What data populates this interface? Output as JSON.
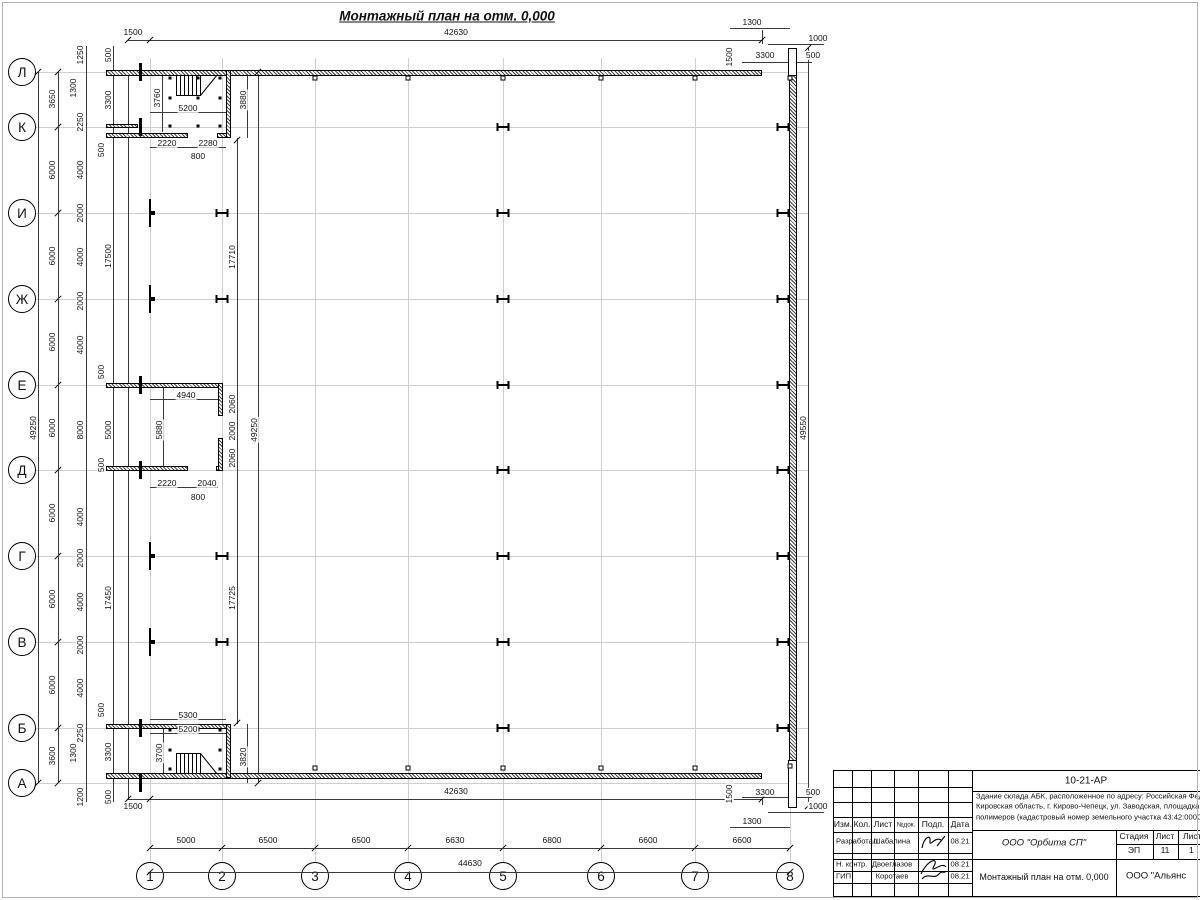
{
  "sheet": {
    "title": "Монтажный план на отм. 0,000"
  },
  "axes": {
    "rows": [
      [
        "Л",
        72
      ],
      [
        "К",
        127
      ],
      [
        "И",
        213
      ],
      [
        "Ж",
        299
      ],
      [
        "Е",
        385
      ],
      [
        "Д",
        470
      ],
      [
        "Г",
        556
      ],
      [
        "В",
        642
      ],
      [
        "Б",
        728
      ],
      [
        "А",
        783
      ]
    ],
    "cols": [
      [
        "1",
        150
      ],
      [
        "2",
        222
      ],
      [
        "3",
        315
      ],
      [
        "4",
        408
      ],
      [
        "5",
        503
      ],
      [
        "6",
        601
      ],
      [
        "7",
        695
      ],
      [
        "8",
        790
      ]
    ]
  },
  "geometry": {
    "dim_labels": [
      [
        "1500",
        133,
        32,
        0
      ],
      [
        "42630",
        456,
        32,
        0
      ],
      [
        "1300",
        752,
        22,
        0
      ],
      [
        "1000",
        818,
        38,
        0
      ],
      [
        "3300",
        765,
        55,
        0
      ],
      [
        "500",
        813,
        55,
        0
      ],
      [
        "1500",
        729,
        57,
        1
      ],
      [
        "1500",
        729,
        794,
        1
      ],
      [
        "3300",
        765,
        792,
        0
      ],
      [
        "500",
        813,
        792,
        0
      ],
      [
        "1000",
        818,
        806,
        0
      ],
      [
        "1300",
        752,
        821,
        0
      ],
      [
        "42630",
        456,
        791,
        0
      ],
      [
        "1500",
        133,
        806,
        0
      ],
      [
        "5000",
        186,
        840,
        0
      ],
      [
        "6500",
        268,
        840,
        0
      ],
      [
        "6500",
        361,
        840,
        0
      ],
      [
        "6630",
        455,
        840,
        0
      ],
      [
        "6800",
        552,
        840,
        0
      ],
      [
        "6600",
        648,
        840,
        0
      ],
      [
        "6600",
        742,
        840,
        0
      ],
      [
        "44630",
        470,
        863,
        0
      ],
      [
        "49250",
        33,
        428,
        1
      ],
      [
        "3650",
        52,
        99,
        1
      ],
      [
        "6000",
        52,
        170,
        1
      ],
      [
        "6000",
        52,
        256,
        1
      ],
      [
        "6000",
        52,
        342,
        1
      ],
      [
        "6000",
        52,
        428,
        1
      ],
      [
        "6000",
        52,
        513,
        1
      ],
      [
        "6000",
        52,
        599,
        1
      ],
      [
        "6000",
        52,
        685,
        1
      ],
      [
        "3600",
        52,
        756,
        1
      ],
      [
        "1250",
        80,
        55,
        1
      ],
      [
        "1300",
        73,
        88,
        1
      ],
      [
        "2250",
        80,
        122,
        1
      ],
      [
        "4000",
        80,
        170,
        1
      ],
      [
        "2000",
        80,
        213,
        1
      ],
      [
        "4000",
        80,
        257,
        1
      ],
      [
        "2000",
        80,
        301,
        1
      ],
      [
        "4000",
        80,
        345,
        1
      ],
      [
        "8000",
        80,
        430,
        1
      ],
      [
        "4000",
        80,
        517,
        1
      ],
      [
        "2000",
        80,
        558,
        1
      ],
      [
        "4000",
        80,
        602,
        1
      ],
      [
        "2000",
        80,
        645,
        1
      ],
      [
        "4000",
        80,
        688,
        1
      ],
      [
        "2250",
        80,
        733,
        1
      ],
      [
        "1300",
        73,
        753,
        1
      ],
      [
        "1200",
        80,
        797,
        1
      ],
      [
        "500",
        108,
        55,
        1
      ],
      [
        "3300",
        108,
        100,
        1
      ],
      [
        "500",
        101,
        150,
        1
      ],
      [
        "17500",
        108,
        256,
        1
      ],
      [
        "500",
        101,
        372,
        1
      ],
      [
        "5000",
        108,
        430,
        1
      ],
      [
        "500",
        101,
        465,
        1
      ],
      [
        "17450",
        108,
        598,
        1
      ],
      [
        "500",
        101,
        710,
        1
      ],
      [
        "3300",
        108,
        752,
        1
      ],
      [
        "500",
        108,
        797,
        1
      ],
      [
        "17710",
        232,
        257,
        1
      ],
      [
        "2060",
        232,
        404,
        1
      ],
      [
        "2000",
        232,
        431,
        1
      ],
      [
        "2060",
        232,
        458,
        1
      ],
      [
        "17725",
        232,
        598,
        1
      ],
      [
        "49250",
        254,
        430,
        1
      ],
      [
        "3880",
        243,
        100,
        1
      ],
      [
        "3820",
        243,
        757,
        1
      ],
      [
        "49550",
        803,
        428,
        1
      ],
      [
        "3760",
        157,
        98,
        1
      ],
      [
        "5200",
        188,
        108,
        0
      ],
      [
        "2220",
        167,
        143,
        0
      ],
      [
        "2280",
        208,
        143,
        0
      ],
      [
        "800",
        198,
        156,
        0
      ],
      [
        "4940",
        186,
        395,
        0
      ],
      [
        "5880",
        159,
        430,
        1
      ],
      [
        "2220",
        167,
        483,
        0
      ],
      [
        "2040",
        207,
        483,
        0
      ],
      [
        "800",
        198,
        497,
        0
      ],
      [
        "5300",
        188,
        715,
        0
      ],
      [
        "5200",
        188,
        729,
        0
      ],
      [
        "3700",
        159,
        753,
        1
      ]
    ],
    "lines": [
      [
        128,
        40,
        634,
        1
      ],
      [
        742,
        62,
        70,
        1
      ],
      [
        768,
        44,
        56,
        1
      ],
      [
        730,
        28,
        60,
        1
      ],
      [
        128,
        799,
        634,
        1
      ],
      [
        742,
        797,
        70,
        1
      ],
      [
        768,
        812,
        56,
        1
      ],
      [
        730,
        827,
        60,
        1
      ],
      [
        150,
        848,
        640,
        1
      ],
      [
        150,
        872,
        640,
        1
      ],
      [
        38,
        72,
        1,
        711
      ],
      [
        58,
        72,
        1,
        711
      ],
      [
        86,
        46,
        1,
        756
      ],
      [
        113,
        46,
        1,
        756
      ],
      [
        237,
        138,
        1,
        586
      ],
      [
        258,
        72,
        1,
        711
      ],
      [
        808,
        48,
        1,
        758
      ],
      [
        247,
        72,
        1,
        66
      ],
      [
        247,
        724,
        1,
        59
      ],
      [
        150,
        112,
        76,
        1
      ],
      [
        150,
        147,
        76,
        1
      ],
      [
        150,
        399,
        68,
        1
      ],
      [
        150,
        487,
        68,
        1
      ],
      [
        150,
        719,
        76,
        1
      ],
      [
        150,
        733,
        76,
        1
      ],
      [
        162,
        76,
        1,
        56
      ],
      [
        163,
        387,
        1,
        79
      ],
      [
        163,
        727,
        1,
        46
      ],
      [
        128,
        70,
        1,
        729
      ],
      [
        762,
        30,
        1,
        14
      ],
      [
        762,
        793,
        1,
        12
      ]
    ],
    "walls": [
      [
        106,
        70,
        656,
        6
      ],
      [
        106,
        773,
        656,
        6
      ],
      [
        789,
        74,
        8,
        688
      ],
      [
        106,
        133,
        82,
        5
      ],
      [
        217,
        133,
        14,
        5
      ],
      [
        226,
        70,
        5,
        68
      ],
      [
        106,
        383,
        114,
        5
      ],
      [
        106,
        466,
        82,
        5
      ],
      [
        216,
        466,
        7,
        5
      ],
      [
        218,
        383,
        5,
        33
      ],
      [
        218,
        438,
        5,
        33
      ],
      [
        106,
        724,
        125,
        5
      ],
      [
        226,
        724,
        5,
        54
      ],
      [
        106,
        124,
        32,
        4
      ]
    ],
    "whiteboxes": [
      [
        788,
        48,
        9,
        28
      ],
      [
        788,
        760,
        9,
        48
      ]
    ],
    "caps": [
      [
        139,
        63
      ],
      [
        139,
        118
      ],
      [
        139,
        376
      ],
      [
        139,
        461
      ],
      [
        139,
        719
      ],
      [
        139,
        774
      ]
    ],
    "hcols": [
      [
        503,
        127
      ],
      [
        503,
        213
      ],
      [
        503,
        299
      ],
      [
        503,
        385
      ],
      [
        503,
        470
      ],
      [
        503,
        556
      ],
      [
        503,
        642
      ],
      [
        503,
        728
      ],
      [
        222,
        213
      ],
      [
        222,
        299
      ],
      [
        222,
        556
      ],
      [
        222,
        642
      ],
      [
        783,
        127
      ],
      [
        783,
        213
      ],
      [
        783,
        299
      ],
      [
        783,
        385
      ],
      [
        783,
        470
      ],
      [
        783,
        556
      ],
      [
        783,
        642
      ],
      [
        783,
        728
      ]
    ],
    "tcols": [
      [
        150,
        213
      ],
      [
        150,
        299
      ],
      [
        150,
        556
      ],
      [
        150,
        642
      ]
    ],
    "squares": [
      [
        315,
        78
      ],
      [
        408,
        78
      ],
      [
        503,
        78
      ],
      [
        601,
        78
      ],
      [
        695,
        78
      ],
      [
        315,
        768
      ],
      [
        408,
        768
      ],
      [
        503,
        768
      ],
      [
        601,
        768
      ],
      [
        695,
        768
      ],
      [
        790,
        78
      ],
      [
        790,
        766
      ]
    ],
    "dots": [
      [
        170,
        78
      ],
      [
        198,
        78
      ],
      [
        220,
        78
      ],
      [
        170,
        98
      ],
      [
        198,
        98
      ],
      [
        220,
        98
      ],
      [
        170,
        126
      ],
      [
        198,
        126
      ],
      [
        220,
        126
      ],
      [
        170,
        730
      ],
      [
        198,
        730
      ],
      [
        220,
        730
      ],
      [
        170,
        750
      ],
      [
        220,
        750
      ],
      [
        170,
        769
      ],
      [
        220,
        769
      ]
    ],
    "extra_ticks": [
      [
        128,
        40
      ],
      [
        150,
        40
      ],
      [
        762,
        40
      ],
      [
        128,
        799
      ],
      [
        150,
        799
      ],
      [
        762,
        799
      ],
      [
        150,
        872
      ],
      [
        790,
        872
      ],
      [
        38,
        72
      ],
      [
        38,
        783
      ],
      [
        258,
        72
      ],
      [
        258,
        783
      ],
      [
        808,
        48
      ],
      [
        808,
        806
      ],
      [
        237,
        140
      ],
      [
        237,
        723
      ]
    ]
  },
  "title_block": {
    "doc_code": "10-21-АР",
    "description_lines": [
      "Здание склада АБК, расположенное по адресу: Российская Феде",
      "Кировская область, г. Кирово-Чепецк, ул. Заводская, площадка з",
      "полимеров (кадастровый номер земельного участка 43:42:0000"
    ],
    "header_cols": [
      "Изм.",
      "Кол.",
      "Лист",
      "№док.",
      "Подп.",
      "Дата"
    ],
    "people": [
      {
        "role": "Разработал",
        "name": "Шабалина",
        "date": "08.21"
      },
      {
        "role": "Н. контр.",
        "name": "Двоеглазов",
        "date": "08.21"
      },
      {
        "role": "ГИП",
        "name": "Коротаев",
        "date": "08.21"
      }
    ],
    "org1": "ООО \"Орбита СП\"",
    "stage_header": [
      "Стадия",
      "Лист",
      "Листов"
    ],
    "stage_values": [
      "ЭП",
      "11",
      "1"
    ],
    "drawing_name": "Монтажный план на отм. 0,000",
    "org2": "ООО \"Альянс"
  }
}
